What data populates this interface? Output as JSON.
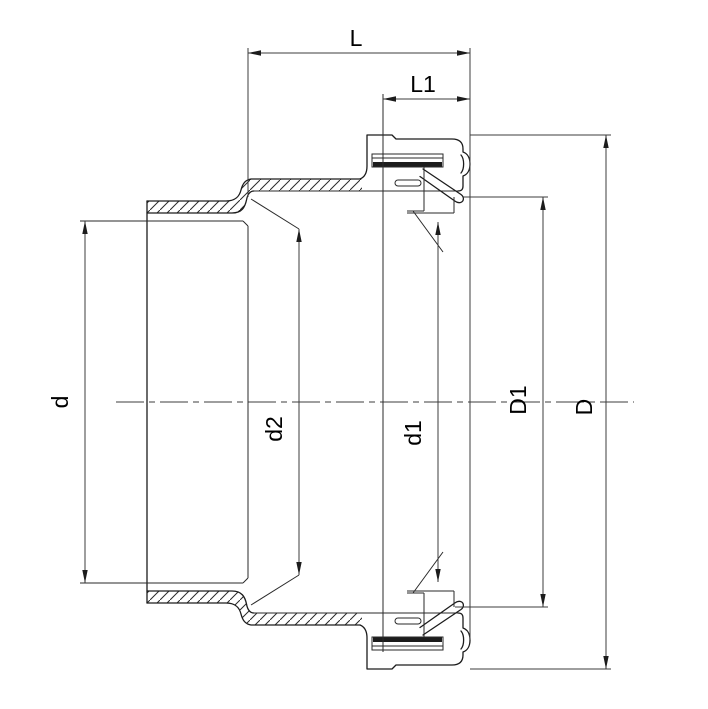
{
  "page": {
    "background": "#ffffff"
  },
  "drawing": {
    "kind": "sectional technical drawing of hose coupling",
    "dimension_labels": {
      "L": "L",
      "L1": "L1",
      "d": "d",
      "d2": "d2",
      "d1": "d1",
      "D1": "D1",
      "D": "D"
    },
    "colors": {
      "part_line": "#1c1c1c",
      "dimension_line": "#3c3c3c",
      "hatch": "#2a2a2a",
      "text": "#000000",
      "background": "#ffffff"
    }
  }
}
